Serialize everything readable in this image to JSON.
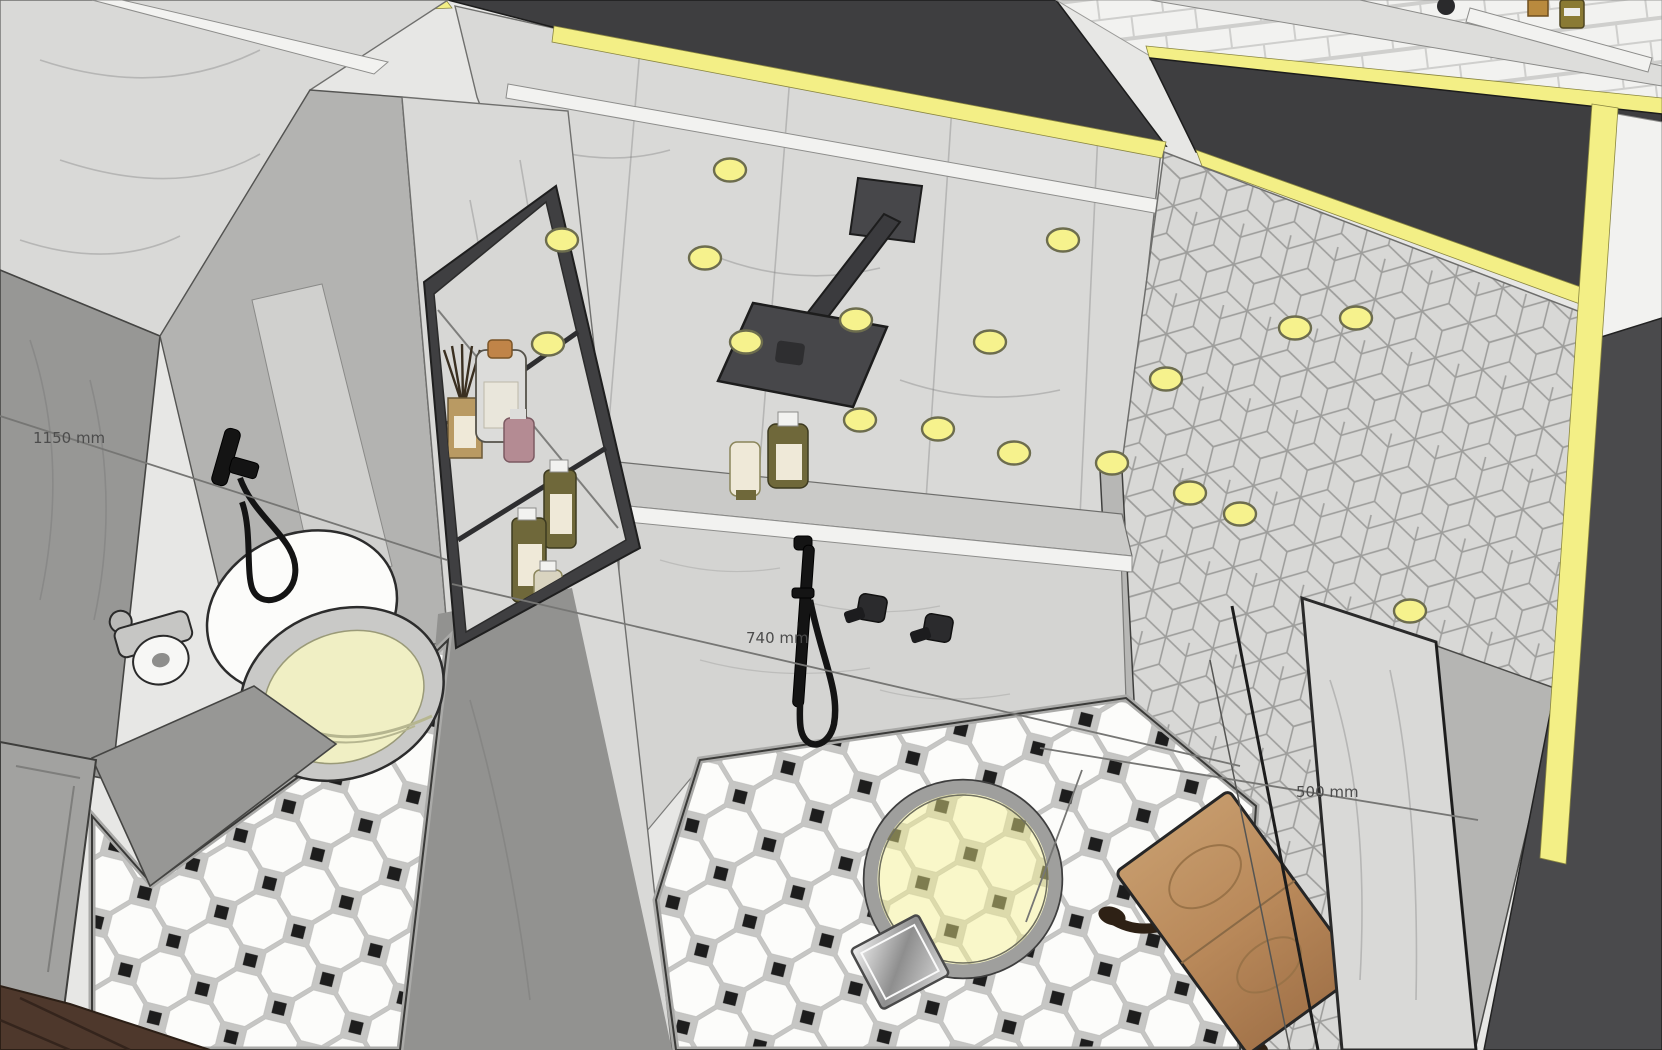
{
  "viewport": {
    "description": "3D bathroom interior model viewed from above (SketchUp-style render) with shower, toilet, niche shelving, patterned tile walls and octagon tile floor"
  },
  "annotations": {
    "dim_left": {
      "label": "1150 mm"
    },
    "dim_center": {
      "label": "740 mm"
    },
    "dim_right": {
      "label": "500 mm"
    }
  },
  "colors": {
    "bg": "#e7e7e5",
    "cut": "#3e3e40",
    "selection": "#f3ef86",
    "lightFill": "#f6f28d",
    "lightStroke": "#6d6d4e",
    "marbleLight": "#d9d9d7",
    "marbleMid": "#c3c3c1",
    "marbleDark": "#979795",
    "wallFace": "#b3b3b1",
    "white": "#f2f2f0",
    "grout": "#c6c6c4",
    "tileWhite": "#fcfcfa",
    "tileDot": "#1d1d1d",
    "wood": "#4e382c",
    "stoolWood": "#b9895a",
    "olive": "#6f683a",
    "cream": "#efe9d8",
    "cork": "#c08448",
    "pink": "#b48b93",
    "fixture": "#141414",
    "bowlCream": "#f0efc4",
    "dimLine": "#767674",
    "dimText": "#4c4c4c"
  },
  "lights": [
    [
      730,
      170
    ],
    [
      562,
      240
    ],
    [
      548,
      344
    ],
    [
      705,
      258
    ],
    [
      746,
      342
    ],
    [
      856,
      320
    ],
    [
      990,
      342
    ],
    [
      1063,
      240
    ],
    [
      1166,
      379
    ],
    [
      1014,
      453
    ],
    [
      938,
      429
    ],
    [
      1190,
      493
    ],
    [
      1295,
      328
    ],
    [
      1356,
      318
    ],
    [
      860,
      420
    ],
    [
      1112,
      463
    ],
    [
      1240,
      514
    ],
    [
      1410,
      611
    ]
  ]
}
